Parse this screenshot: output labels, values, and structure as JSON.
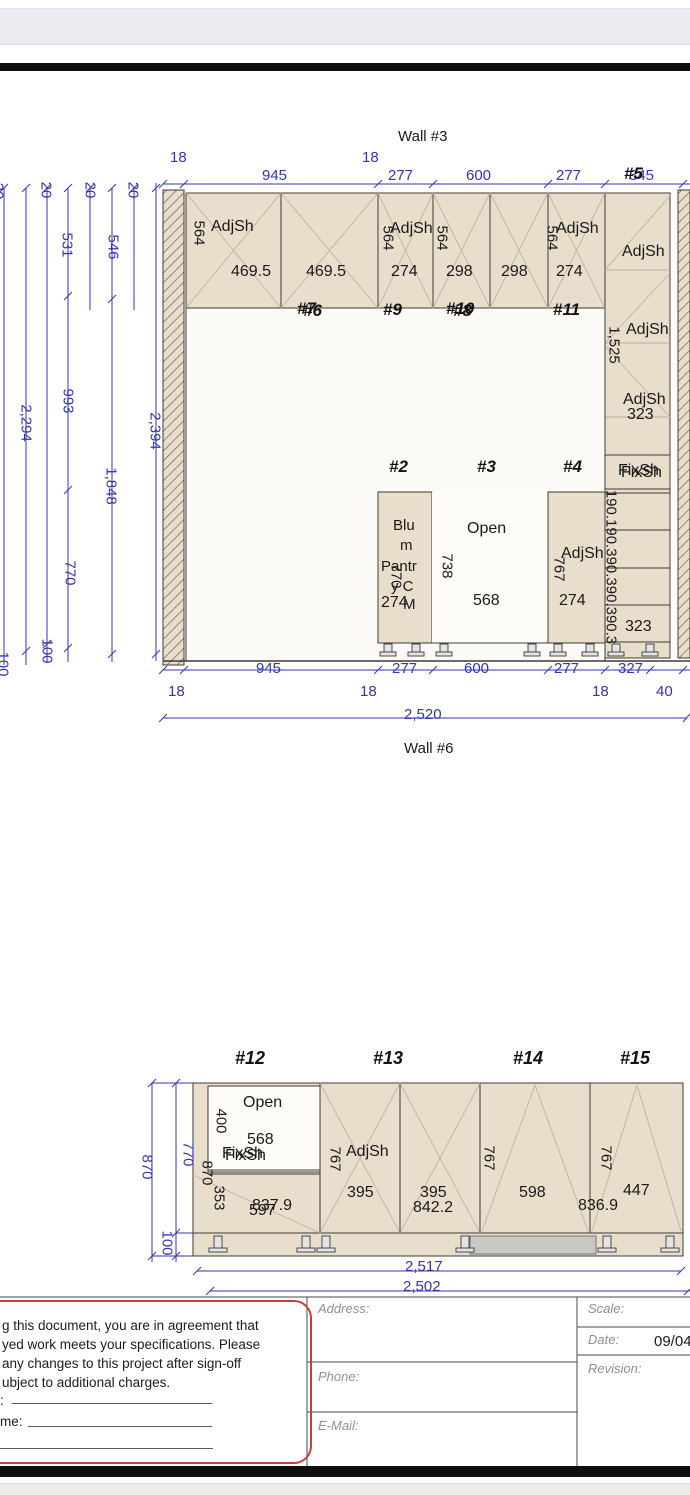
{
  "page": {
    "wall3_title": "Wall #3",
    "wall6_title": "Wall #6"
  },
  "w3top": {
    "o18a": "18",
    "o18b": "18",
    "d945": "945",
    "d277a": "277",
    "d600": "600",
    "d277b": "277",
    "d345": "345"
  },
  "w3left": {
    "t20a": "20",
    "t20b": "20",
    "t20c": "20",
    "t20d": "20",
    "v2294": "2,294",
    "v100a": "100",
    "v100b": "100",
    "v531": "531",
    "v993": "993",
    "v770": "770",
    "v546": "546",
    "v1848": "1,848",
    "v2394": "2,394"
  },
  "w3bottom": {
    "d945": "945",
    "d277a": "277",
    "d600": "600",
    "d277b": "277",
    "d327": "327",
    "o18a": "18",
    "o18b": "18",
    "o18c": "18",
    "o40": "40",
    "total": "2,520"
  },
  "cab": {
    "c6": {
      "label": "#6",
      "ghost": "#7",
      "depth": "564",
      "shelf": "AdjSh",
      "door1": "469.5",
      "door2": "469.5"
    },
    "c9": {
      "label": "#9",
      "depth": "564",
      "shelf": "AdjSh",
      "door": "274"
    },
    "c8": {
      "label": "#8",
      "ghost": "#10",
      "depth": "564",
      "door1": "298",
      "door2": "298"
    },
    "c11": {
      "label": "#11",
      "depth": "564",
      "shelf": "AdjSh",
      "door": "274"
    },
    "c5": {
      "label": "#5",
      "shelf1": "AdjSh",
      "shelf2": "AdjSh",
      "shelf3": "AdjSh",
      "height": "1,525",
      "s323": "323",
      "fix": "FixSh",
      "drawers": "190.190.390.390.390.3",
      "b323": "323"
    },
    "c2": {
      "label": "#2",
      "l1": "Blu",
      "l2": "m",
      "l3": "Pantr",
      "l4": "y C",
      "l5": "M",
      "height": "770",
      "door": "274"
    },
    "c3": {
      "label": "#3",
      "open": "Open",
      "height": "738",
      "width": "568"
    },
    "c4": {
      "label": "#4",
      "height": "767",
      "shelf": "AdjSh",
      "door": "274"
    }
  },
  "lower": {
    "c12": {
      "label": "#12",
      "open": "Open",
      "h400": "400",
      "w568": "568",
      "fix": "FixSh",
      "h870": "870",
      "h353": "353",
      "w597": "597",
      "w837": "837.9"
    },
    "c13": {
      "label": "#13",
      "height": "767",
      "shelf": "AdjSh",
      "door1": "395",
      "door2": "395",
      "width": "842.2"
    },
    "c14": {
      "label": "#14",
      "height": "767",
      "width": "598"
    },
    "c15": {
      "label": "#15",
      "height": "767",
      "door": "447",
      "width": "836.9"
    },
    "left": {
      "v770": "770",
      "v870": "870",
      "v100": "100"
    },
    "totals": {
      "t2517": "2,517",
      "t2502": "2,502"
    }
  },
  "titleblock": {
    "disclaimer": {
      "l1": "g this document, you are in agreement that",
      "l2": "yed work meets your specifications. Please",
      "l3": "any changes to this project after sign-off",
      "l4": "ubject to additional charges.",
      "sig": ":",
      "name": "me:"
    },
    "address": "Address:",
    "phone": "Phone:",
    "email": "E-Mail:",
    "scale": "Scale:",
    "date": "Date:",
    "date_value": "09/04",
    "revision": "Revision:"
  }
}
